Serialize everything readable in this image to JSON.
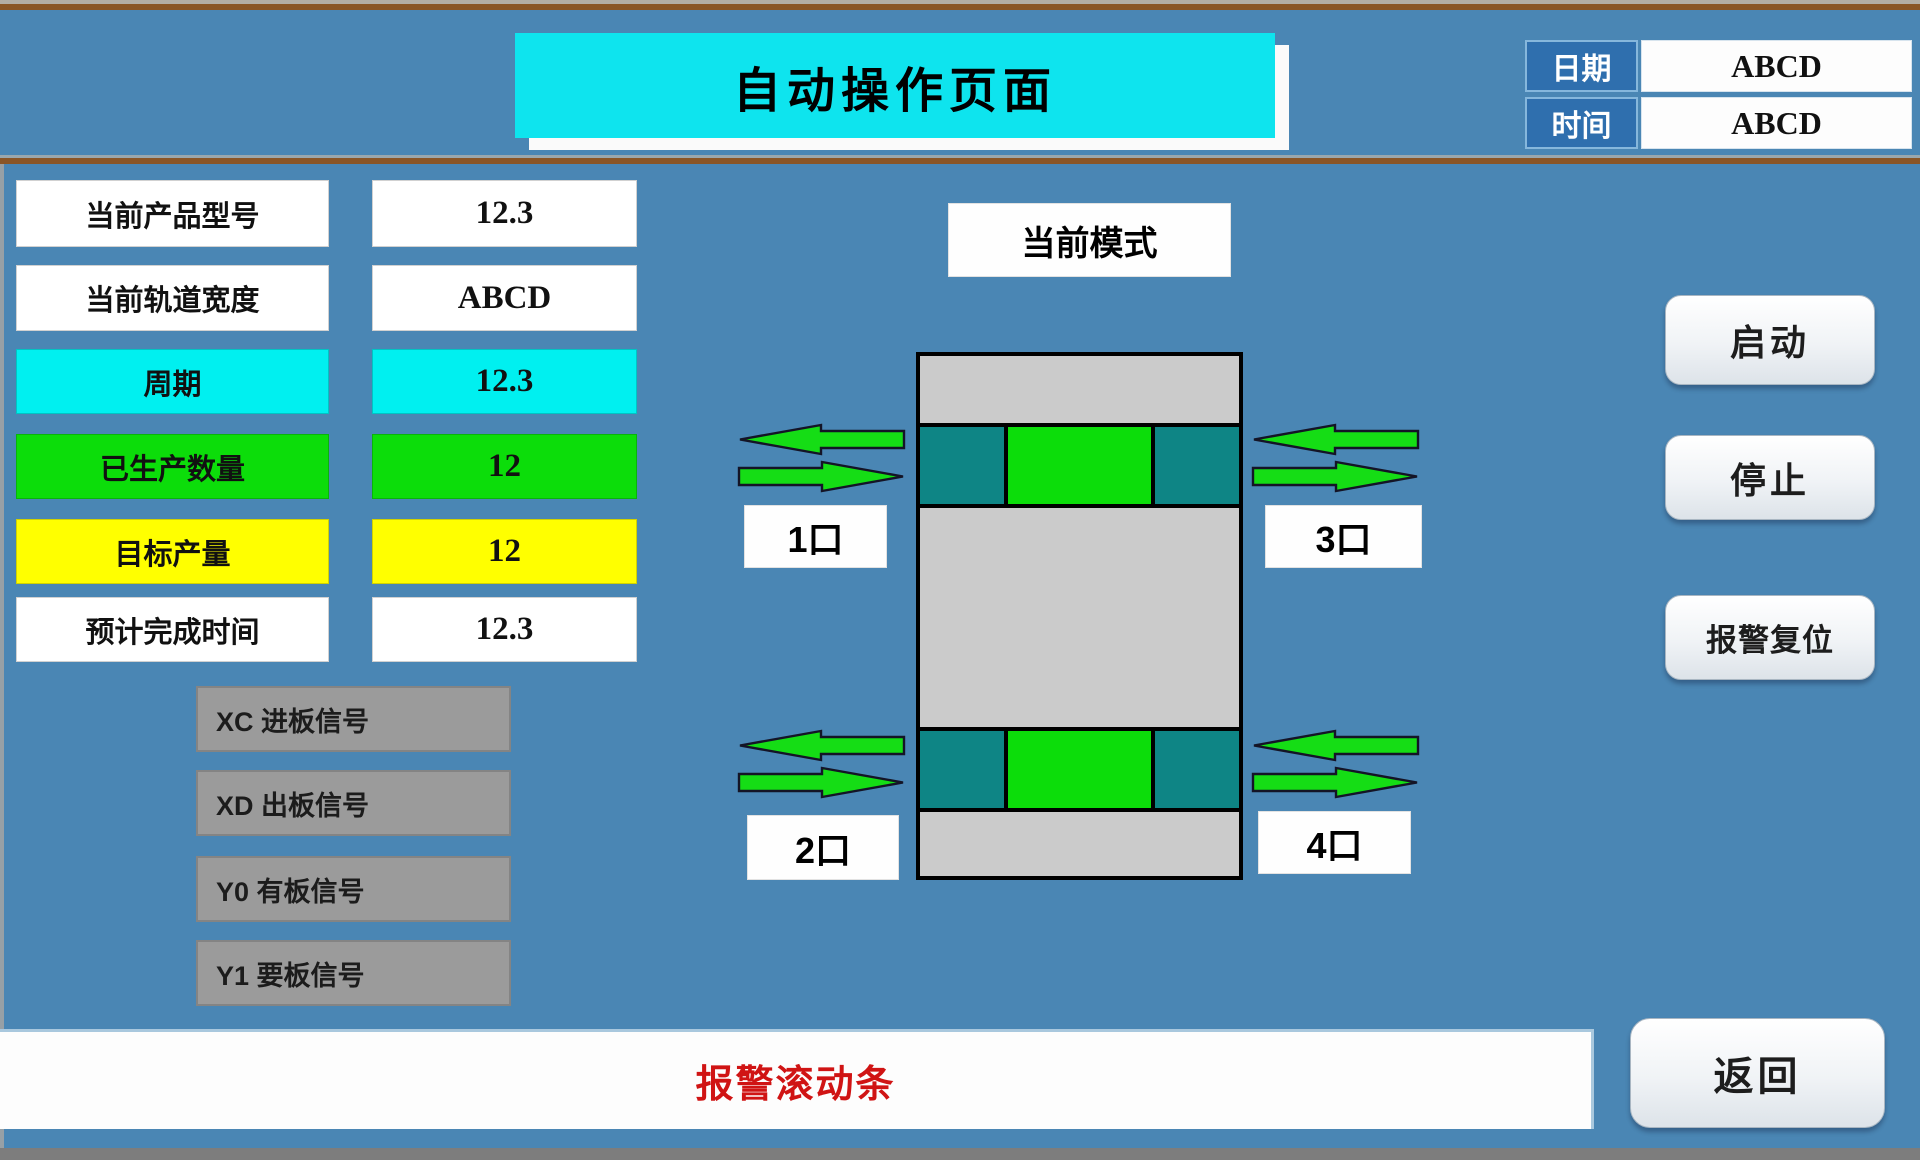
{
  "title": "自动操作页面",
  "header": {
    "date_label": "日期",
    "date_value": "ABCD",
    "time_label": "时间",
    "time_value": "ABCD"
  },
  "info_rows": [
    {
      "label": "当前产品型号",
      "value": "12.3",
      "bg": "#ffffff"
    },
    {
      "label": "当前轨道宽度",
      "value": "ABCD",
      "bg": "#ffffff"
    },
    {
      "label": "周期",
      "value": "12.3",
      "bg": "#00f0f0"
    },
    {
      "label": "已生产数量",
      "value": "12",
      "bg": "#0cdd0a"
    },
    {
      "label": "目标产量",
      "value": "12",
      "bg": "#ffff00"
    },
    {
      "label": "预计完成时间",
      "value": "12.3",
      "bg": "#ffffff"
    }
  ],
  "signals": [
    {
      "label": "XC 进板信号"
    },
    {
      "label": "XD 出板信号"
    },
    {
      "label": "Y0 有板信号"
    },
    {
      "label": "Y1 要板信号"
    }
  ],
  "diagram": {
    "mode_label": "当前模式",
    "ports": [
      {
        "label": "1口"
      },
      {
        "label": "2口"
      },
      {
        "label": "3口"
      },
      {
        "label": "4口"
      }
    ]
  },
  "buttons": {
    "start": "启动",
    "stop": "停止",
    "alarm_reset": "报警复位",
    "back": "返回"
  },
  "alarm_bar": {
    "text": "报警滚动条"
  },
  "colors": {
    "background": "#4a86b4",
    "title_bg": "#0ee4ee",
    "machine_gray": "#cbcbcb",
    "teal_block": "#0e8585",
    "green_block": "#0cdd0a",
    "arrow_green": "#15dd15",
    "signal_gray": "#9b9b9b",
    "alarm_text": "#d01414",
    "header_label_bg": "#2f6fae",
    "frame_brown": "#8a5526"
  }
}
